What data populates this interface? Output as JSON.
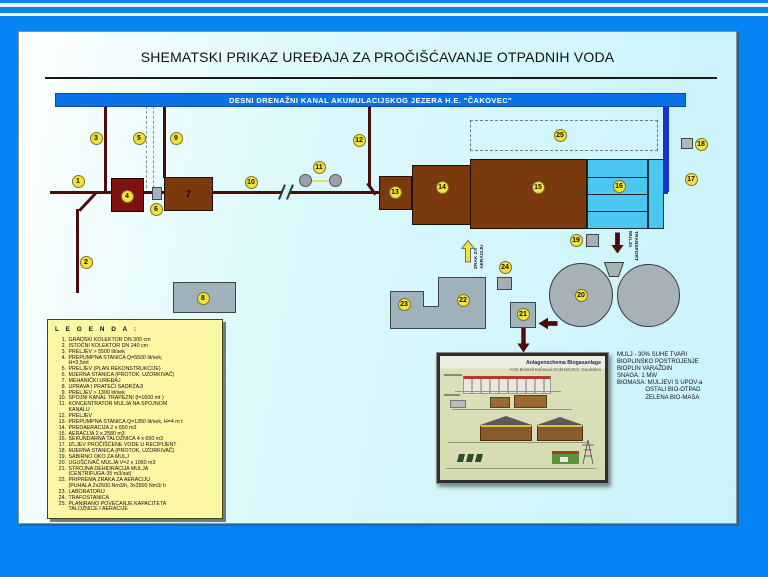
{
  "title": "SHEMATSKI PRIKAZ UREĐAJA ZA PROČIŠĆAVANJE OTPADNIH VODA",
  "banner": {
    "label": "DESNI DRENAŽNI KANAL AKUMULACIJSKOG JEZERA H.E. \"ČAKOVEC\""
  },
  "legend": {
    "title": "L E G E N D A :",
    "items": [
      {
        "n": "1.",
        "t": "GRADSKI KOLEKTOR DN 300 cm"
      },
      {
        "n": "2.",
        "t": "ISTOČNI KOLEKTOR DN 240 cm"
      },
      {
        "n": "3.",
        "t": "PRELJEV > 5500 lit/sek"
      },
      {
        "n": "4.",
        "t": "PREPUMPNA STANICA Q=5500 lit/sek,\nH=3,5mt"
      },
      {
        "n": "5.",
        "t": "PRELJEV (PLAN REKONSTRUKCIJE)"
      },
      {
        "n": "6.",
        "t": "MJERNA STANICA (PROTOK, UZORKIVAČ)"
      },
      {
        "n": "7.",
        "t": "MEHANIČKI UREĐAJ"
      },
      {
        "n": "8.",
        "t": "UPRAVA I PRATEĆI SADRŽAJI"
      },
      {
        "n": "9.",
        "t": "PRELJEV > 1300 lit/sek"
      },
      {
        "n": "10.",
        "t": "SPOJNI KANAL  TRAPEZNI (l=1600 mt )"
      },
      {
        "n": "11.",
        "t": "KONCENTRATOR MULJA NA SPOJNOM\nKANALU"
      },
      {
        "n": "12.",
        "t": "PRELJEV"
      },
      {
        "n": "13.",
        "t": "PREPUMPNA STANICA Q=1350 lit/sek, H=4 m t"
      },
      {
        "n": "14.",
        "t": "PREDAERACIJA 2 x 650 m3"
      },
      {
        "n": "15.",
        "t": "AERACIJA 2 x  2580 m3"
      },
      {
        "n": "16.",
        "t": "SEKUNDARNA TALOŽNICA  4 x 650 m3"
      },
      {
        "n": "17.",
        "t": "IZLJEV PROČIŠĆENE VODE U RECIPIJENT"
      },
      {
        "n": "18.",
        "t": "MJERNA STANICA (PROTOK, UZORKIVAČ)"
      },
      {
        "n": "19.",
        "t": "SABIRNO OKO ZA MULJ"
      },
      {
        "n": "20.",
        "t": "UGUŠĆIVAČ MULJA  V=2 x 1050 m3"
      },
      {
        "n": "21.",
        "t": "STROJNA DEHIDRACIJA MULJA\n(CENTRIFUGA-35 m3/sat)"
      },
      {
        "n": "22.",
        "t": "PRIPREMA ZRAKA  ZA AERACIJU\n(PUHALA  2x2500 Nm3/h, 3x3500 Nm3/ h"
      },
      {
        "n": "23.",
        "t": "LABORATORIJ"
      },
      {
        "n": "24.",
        "t": "TRAFOSTANICA"
      },
      {
        "n": "25.",
        "t": "PLANIRANO POVEĆANJE KAPACITETA\nTALOŽNICE I AERACIJE"
      }
    ]
  },
  "diagram": {
    "box7_label": "7",
    "labels": {
      "air": "ZRAK ZA\nAERACIJU",
      "transport": "TRANSPORT\nMULJA"
    },
    "markers": [
      {
        "n": "1",
        "x": 71.5,
        "y": 174.5
      },
      {
        "n": "2",
        "x": 79.5,
        "y": 255.5
      },
      {
        "n": "3",
        "x": 89.5,
        "y": 131.5
      },
      {
        "n": "4",
        "x": 120.5,
        "y": 189.5
      },
      {
        "n": "5",
        "x": 132.5,
        "y": 131.5
      },
      {
        "n": "6",
        "x": 149.5,
        "y": 202.5
      },
      {
        "n": "8",
        "x": 196.5,
        "y": 291.5
      },
      {
        "n": "9",
        "x": 169.5,
        "y": 131.5
      },
      {
        "n": "10",
        "x": 244.5,
        "y": 175.5
      },
      {
        "n": "11",
        "x": 312.5,
        "y": 160.5
      },
      {
        "n": "12",
        "x": 352.5,
        "y": 133.5
      },
      {
        "n": "13",
        "x": 388.5,
        "y": 185.5
      },
      {
        "n": "14",
        "x": 435.5,
        "y": 180.5
      },
      {
        "n": "15",
        "x": 531.5,
        "y": 180.5
      },
      {
        "n": "16",
        "x": 612.5,
        "y": 179.5
      },
      {
        "n": "17",
        "x": 684.5,
        "y": 172.5
      },
      {
        "n": "18",
        "x": 694.5,
        "y": 137.5
      },
      {
        "n": "19",
        "x": 569.5,
        "y": 233.5
      },
      {
        "n": "20",
        "x": 574.5,
        "y": 288.5
      },
      {
        "n": "21",
        "x": 516.5,
        "y": 307.5
      },
      {
        "n": "22",
        "x": 456.5,
        "y": 293.5
      },
      {
        "n": "23",
        "x": 397.5,
        "y": 297.5
      },
      {
        "n": "24",
        "x": 498.5,
        "y": 260.5
      },
      {
        "n": "25",
        "x": 553.5,
        "y": 128.5
      }
    ]
  },
  "info_text": "MULJ - 30% SUHE TVARI\nBIOPLINSKO POSTROJENJE\nBIOPLIN VARAŽDIN\nSNAGA: 1 MW\nBIOMASA: MULJEVI S UPOV-a\n                 OSTALI BIO-OTPAD\n                 ZELENA BIO-MASA",
  "photo": {
    "title": "Anlagenschema Biogasanlage",
    "subtitle": "KSK Biokraft Kußmaul GmbH&CoKG, Gaufelden"
  },
  "colors": {
    "frame_blue": "#0584f4",
    "canal_blue": "#0a72e4",
    "outfall_blue": "#1535cf",
    "pipe_red": "#4a0c0c",
    "pump_red": "#7e120e",
    "tank_brown": "#7b3a0d",
    "clarifier_blue": "#4cc7f2",
    "marker_yellow": "#f2e23a",
    "legend_yellow": "#fbf7a4"
  }
}
